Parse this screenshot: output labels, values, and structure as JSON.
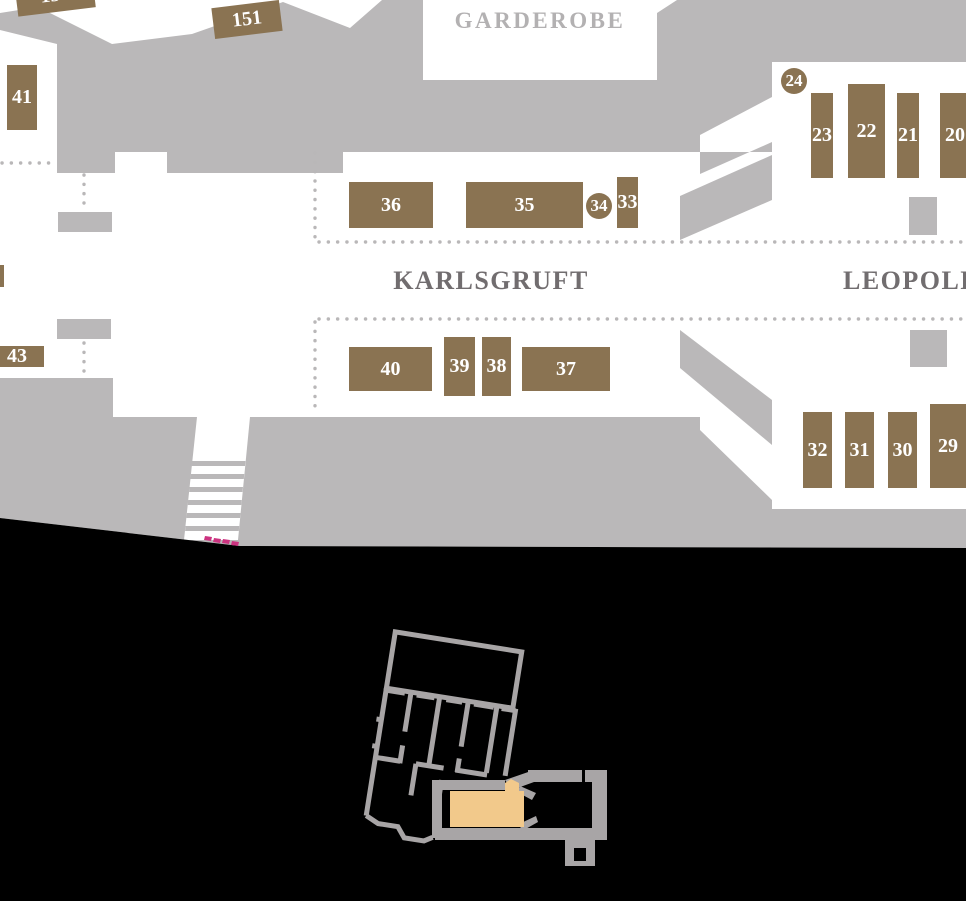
{
  "map": {
    "rooms": {
      "garderobe": "GARDEROBE",
      "karlsgruft": "KARLSGRUFT",
      "leopold": "LEOPOLD"
    },
    "tombs": [
      {
        "label": "150",
        "shape": "rect",
        "x": 16,
        "y": -22,
        "w": 78,
        "h": 34,
        "rot": -7
      },
      {
        "label": "151",
        "shape": "rect",
        "x": 213,
        "y": 4,
        "w": 68,
        "h": 31,
        "rot": -7
      },
      {
        "label": "41",
        "shape": "rect",
        "x": 7,
        "y": 65,
        "w": 30,
        "h": 65,
        "rot": 0
      },
      {
        "label": "",
        "shape": "rect",
        "x": -5,
        "y": 265,
        "w": 9,
        "h": 22,
        "rot": 0
      },
      {
        "label": "43",
        "shape": "rect",
        "x": -10,
        "y": 346,
        "w": 54,
        "h": 21,
        "rot": 0
      },
      {
        "label": "36",
        "shape": "rect",
        "x": 349,
        "y": 182,
        "w": 84,
        "h": 46,
        "rot": 0
      },
      {
        "label": "35",
        "shape": "rect",
        "x": 466,
        "y": 182,
        "w": 117,
        "h": 46,
        "rot": 0
      },
      {
        "label": "34",
        "shape": "circle",
        "x": 586,
        "y": 193,
        "w": 26,
        "h": 26,
        "rot": 0
      },
      {
        "label": "33",
        "shape": "rect",
        "x": 617,
        "y": 177,
        "w": 21,
        "h": 51,
        "rot": 0
      },
      {
        "label": "24",
        "shape": "circle",
        "x": 781,
        "y": 68,
        "w": 26,
        "h": 26,
        "rot": 0
      },
      {
        "label": "23",
        "shape": "rect",
        "x": 811,
        "y": 93,
        "w": 22,
        "h": 85,
        "rot": 0
      },
      {
        "label": "22",
        "shape": "rect",
        "x": 848,
        "y": 84,
        "w": 37,
        "h": 94,
        "rot": 0
      },
      {
        "label": "21",
        "shape": "rect",
        "x": 897,
        "y": 93,
        "w": 22,
        "h": 85,
        "rot": 0
      },
      {
        "label": "20",
        "shape": "rect",
        "x": 940,
        "y": 93,
        "w": 30,
        "h": 85,
        "rot": 0
      },
      {
        "label": "40",
        "shape": "rect",
        "x": 349,
        "y": 347,
        "w": 83,
        "h": 44,
        "rot": 0
      },
      {
        "label": "39",
        "shape": "rect",
        "x": 444,
        "y": 337,
        "w": 31,
        "h": 59,
        "rot": 0
      },
      {
        "label": "38",
        "shape": "rect",
        "x": 482,
        "y": 337,
        "w": 29,
        "h": 59,
        "rot": 0
      },
      {
        "label": "37",
        "shape": "rect",
        "x": 522,
        "y": 347,
        "w": 88,
        "h": 44,
        "rot": 0
      },
      {
        "label": "32",
        "shape": "rect",
        "x": 803,
        "y": 412,
        "w": 29,
        "h": 76,
        "rot": 0
      },
      {
        "label": "31",
        "shape": "rect",
        "x": 845,
        "y": 412,
        "w": 29,
        "h": 76,
        "rot": 0
      },
      {
        "label": "30",
        "shape": "rect",
        "x": 888,
        "y": 412,
        "w": 29,
        "h": 76,
        "rot": 0
      },
      {
        "label": "29",
        "shape": "rect",
        "x": 930,
        "y": 404,
        "w": 36,
        "h": 84,
        "rot": 0
      }
    ],
    "colors": {
      "tomb_brown": "#8a7352",
      "wall_gray": "#bab8b9",
      "dotted_gray": "#b9b7b8",
      "room_label_light": "#b3b1b2",
      "room_label_dark": "#716d6f",
      "route_pink": "#cc3380",
      "upper_background": "#ffffff",
      "lower_background": "#000000",
      "minimap_wall": "#a8a5a6",
      "minimap_highlight": "#f2c98b"
    }
  }
}
